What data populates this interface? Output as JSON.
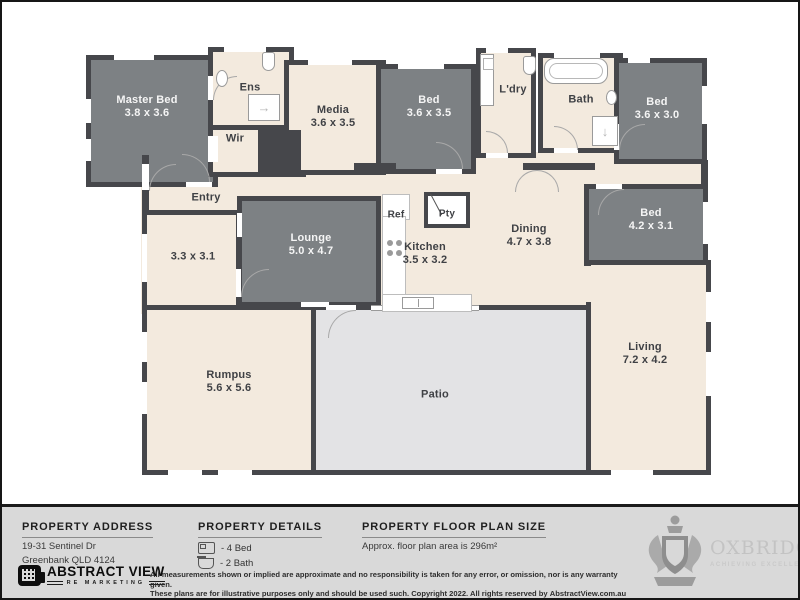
{
  "plan": {
    "rooms": {
      "master_bed": {
        "name": "Master Bed",
        "dims": "3.8 x 3.6"
      },
      "ens": {
        "name": "Ens"
      },
      "wir": {
        "name": "Wir"
      },
      "media": {
        "name": "Media",
        "dims": "3.6 x 3.5"
      },
      "bed_2": {
        "name": "Bed",
        "dims": "3.6 x 3.5"
      },
      "laundry": {
        "name": "L'dry"
      },
      "bath": {
        "name": "Bath"
      },
      "bed_3": {
        "name": "Bed",
        "dims": "3.6 x 3.0"
      },
      "bed_4": {
        "name": "Bed",
        "dims": "4.2 x 3.1"
      },
      "entry": {
        "name": "Entry"
      },
      "store_room": {
        "dims": "3.3 x 3.1"
      },
      "lounge": {
        "name": "Lounge",
        "dims": "5.0 x 4.7"
      },
      "fridge": {
        "name": "Ref"
      },
      "pantry": {
        "name": "Pty"
      },
      "kitchen": {
        "name": "Kitchen",
        "dims": "3.5 x 3.2"
      },
      "dining": {
        "name": "Dining",
        "dims": "4.7 x 3.8"
      },
      "rumpus": {
        "name": "Rumpus",
        "dims": "5.6 x 5.6"
      },
      "patio": {
        "name": "Patio"
      },
      "living": {
        "name": "Living",
        "dims": "7.2 x 4.2"
      }
    },
    "icons": {
      "shower_arrow_right": "→",
      "shower_arrow_down": "↓"
    }
  },
  "footer": {
    "address": {
      "heading": "PROPERTY ADDRESS",
      "line1": "19-31 Sentinel Dr",
      "line2": "Greenbank QLD 4124"
    },
    "details": {
      "heading": "PROPERTY DETAILS",
      "beds": "- 4 Bed",
      "baths": "- 2 Bath"
    },
    "plan_size": {
      "heading": "PROPERTY FLOOR PLAN SIZE",
      "text": "Approx. floor plan area is 296m²"
    },
    "disclaimer": {
      "line1": "All measurements shown or implied are approximate and no responsibility is taken for any error, or omission, nor is any warranty given.",
      "line2": "These plans are for illustrative purposes only and should be used such. Copyright 2022. All rights reserved by ",
      "brand": "AbstractView.com.au"
    },
    "abstract_view_logo": {
      "title": "ABSTRACT VIEW",
      "subtitle": "RE MARKETING"
    },
    "oxbridge_logo": {
      "title": "OXBRIDGE",
      "subtitle": "ACHIEVING EXCELLENCE"
    }
  },
  "colors": {
    "wall": "#46474b",
    "carpet": "#7d8184",
    "floor": "#f3eade",
    "patio": "#e3e3e5",
    "footer_bg": "#d9d9d9"
  }
}
